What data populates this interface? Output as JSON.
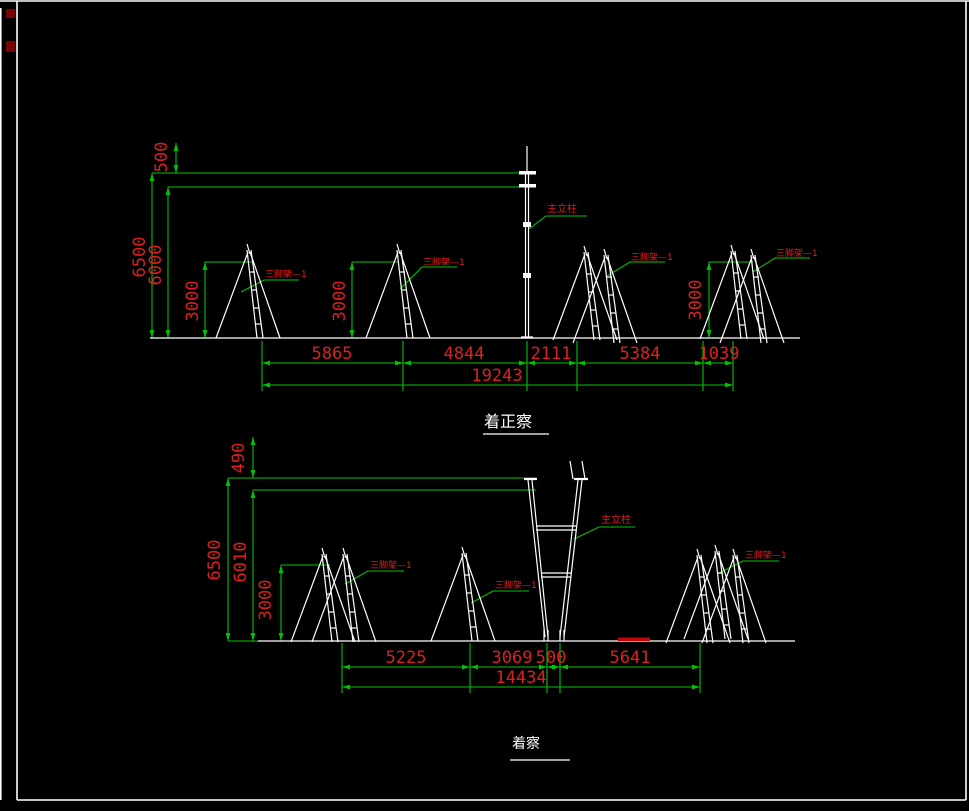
{
  "colors": {
    "background": "#000000",
    "frame": "#ffffff",
    "dimension_green": "#00c300",
    "annotation_red": "#dc1f1f",
    "geometry_white": "#ffffff",
    "ground_mark_red": "#c00505"
  },
  "front_view": {
    "title": "着正察",
    "dims": {
      "v500": "500",
      "v6500": "6500",
      "v6000": "6000",
      "h3000_1": "3000",
      "h3000_2": "3000",
      "h3000_3": "3000",
      "s1": "5865",
      "s2": "4844",
      "s3": "2111",
      "s4": "5384",
      "s5": "1039",
      "total": "19243"
    },
    "labels": {
      "main_column": "主立柱",
      "tripod": "三脚架—1"
    }
  },
  "side_view": {
    "title": "着察",
    "dims": {
      "v490": "490",
      "v6500": "6500",
      "v6010": "6010",
      "v3000": "3000",
      "s1": "5225",
      "s2": "3069",
      "s3": "500",
      "s4": "5641",
      "total": "14434"
    },
    "labels": {
      "main_column": "主立柱",
      "tripod": "三脚架—1"
    }
  }
}
